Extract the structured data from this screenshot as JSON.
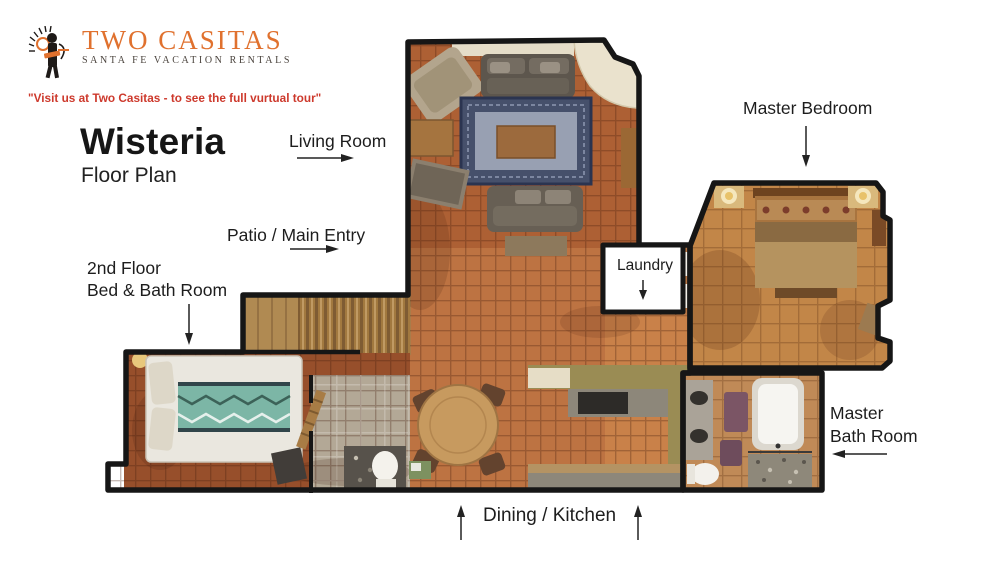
{
  "brand": {
    "name": "Two Casitas",
    "subtitle": "SANTA FE VACATION RENTALS",
    "tagline": "\"Visit us at Two Casitas - to see the full vurtual tour\"",
    "accent_orange": "#e0712e",
    "tagline_red": "#cd392c"
  },
  "title": {
    "main": "Wisteria",
    "sub": "Floor Plan"
  },
  "labels": {
    "living_room": {
      "text": "Living Room",
      "arrow": "right"
    },
    "master_bedroom": {
      "text": "Master Bedroom",
      "arrow": "down"
    },
    "patio_main_entry": {
      "text": "Patio / Main Entry",
      "arrow": "right"
    },
    "laundry": {
      "text": "Laundry",
      "arrow": "down"
    },
    "second_floor": {
      "line1": "2nd Floor",
      "line2": "Bed & Bath Room",
      "arrow": "down"
    },
    "master_bath": {
      "line1": "Master",
      "line2": "Bath Room",
      "arrow": "left"
    },
    "dining_kitchen": {
      "text": "Dining / Kitchen",
      "arrow": "up-both"
    }
  },
  "floorplan": {
    "wall_color": "#161616",
    "tile_terracotta": "#bd7342",
    "tile_tan": "#c28648",
    "tile_dark": "#974f2b",
    "bath_gray": "#b3a896",
    "counter_olive": "#9a8c54",
    "rug_navy": "#46506b",
    "bed_teal": "#7cb6a6"
  }
}
